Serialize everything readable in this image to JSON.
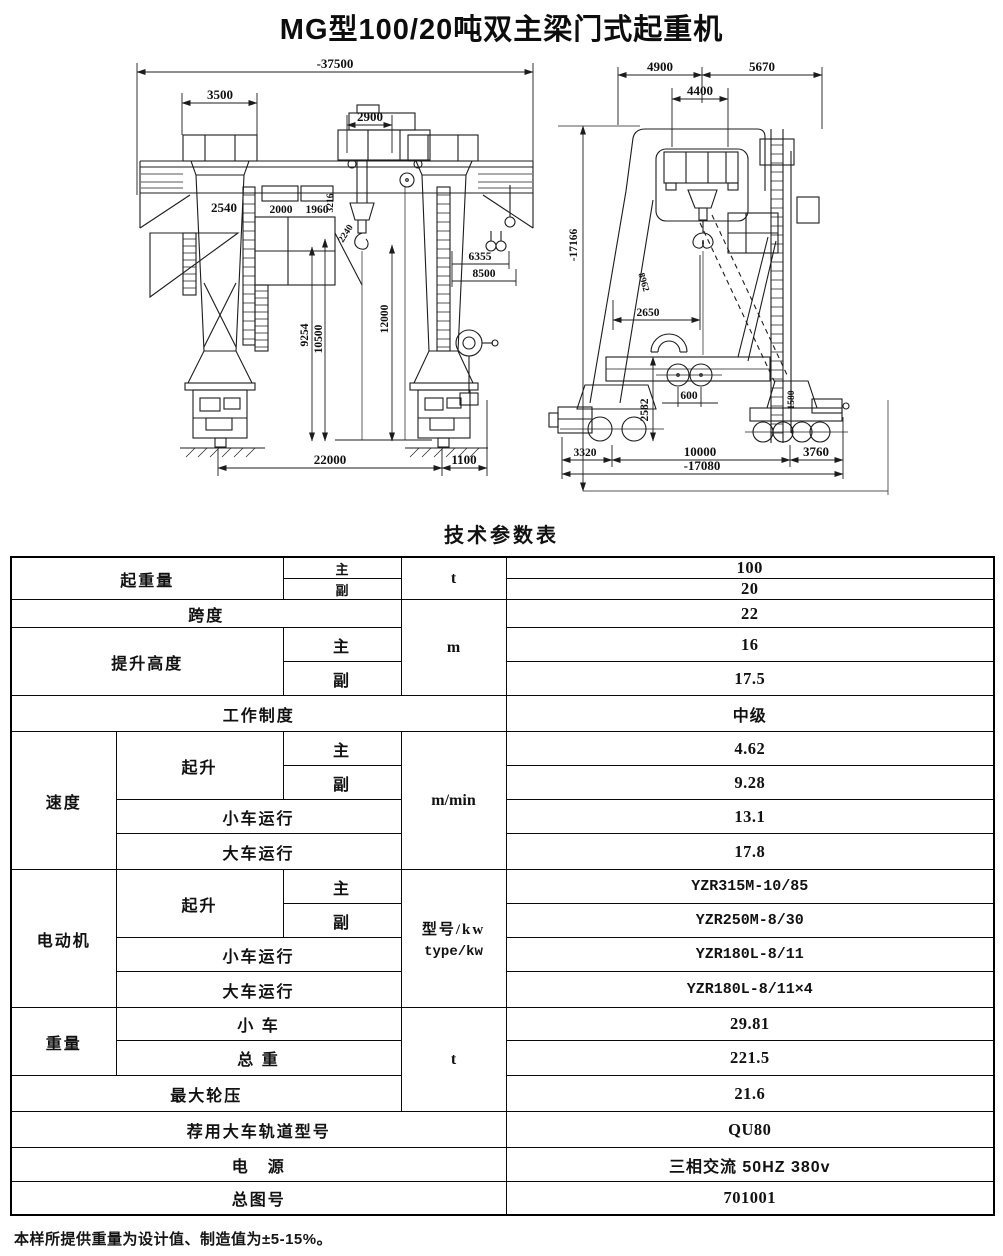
{
  "page": {
    "title": "MG型100/20吨双主梁门式起重机",
    "table_title": "技术参数表",
    "footnote": "本样所提供重量为设计值、制造值为±5-15%。"
  },
  "drawing": {
    "front": {
      "overall_width": "-37500",
      "cap_width": "3500",
      "trolley_gauge": "2900",
      "leg_top_width": "2540",
      "hoist_main": "2000",
      "hoist_aux": "1960",
      "dim_3216": "3216",
      "dim_2240": "2240",
      "dim_6355": "6355",
      "dim_8500": "8500",
      "dim_9254": "9254",
      "dim_10500": "10500",
      "dim_12000": "12000",
      "span": "22000",
      "dim_1100": "1100"
    },
    "side": {
      "dim_4900": "4900",
      "dim_5670": "5670",
      "dim_4400": "4400",
      "overall_height": "-17166",
      "dim_8962": "8962",
      "dim_2650": "2650",
      "dim_2582": "2582",
      "dim_600": "600",
      "dim_1580": "1580",
      "dim_3320": "3320",
      "wheel_base": "10000",
      "dim_3760": "3760",
      "overall_length": "-17080"
    }
  },
  "table": {
    "lifting_capacity": {
      "label": "起重量",
      "main_label": "主",
      "aux_label": "副",
      "unit": "t",
      "main_value": "100",
      "aux_value": "20"
    },
    "span": {
      "label": "跨度",
      "value": "22"
    },
    "lifting_height": {
      "label": "提升高度",
      "main_label": "主",
      "aux_label": "副",
      "unit": "m",
      "main_value": "16",
      "aux_value": "17.5"
    },
    "duty_class": {
      "label": "工作制度",
      "value": "中级"
    },
    "speed": {
      "label": "速度",
      "hoist_label": "起升",
      "main_label": "主",
      "aux_label": "副",
      "trolley_label": "小车运行",
      "gantry_label": "大车运行",
      "unit": "m/min",
      "hoist_main": "4.62",
      "hoist_aux": "9.28",
      "trolley_travel": "13.1",
      "gantry_travel": "17.8"
    },
    "motor": {
      "label": "电动机",
      "hoist_label": "起升",
      "main_label": "主",
      "aux_label": "副",
      "trolley_label": "小车运行",
      "gantry_label": "大车运行",
      "unit_cn": "型号/kw",
      "unit_en": "type/kw",
      "hoist_main": "YZR315M-10/85",
      "hoist_aux": "YZR250M-8/30",
      "trolley_travel": "YZR180L-8/11",
      "gantry_travel": "YZR180L-8/11×4"
    },
    "weight": {
      "label": "重量",
      "trolley_label": "小 车",
      "total_label": "总 重",
      "unit": "t",
      "trolley_value": "29.81",
      "total_value": "221.5"
    },
    "max_wheel_load": {
      "label": "最大轮压",
      "value": "21.6"
    },
    "rail_type": {
      "label": "荐用大车轨道型号",
      "value": "QU80"
    },
    "power_supply": {
      "label": "电　源",
      "value": "三相交流 50HZ 380v"
    },
    "drawing_no": {
      "label": "总图号",
      "value": "701001"
    }
  }
}
